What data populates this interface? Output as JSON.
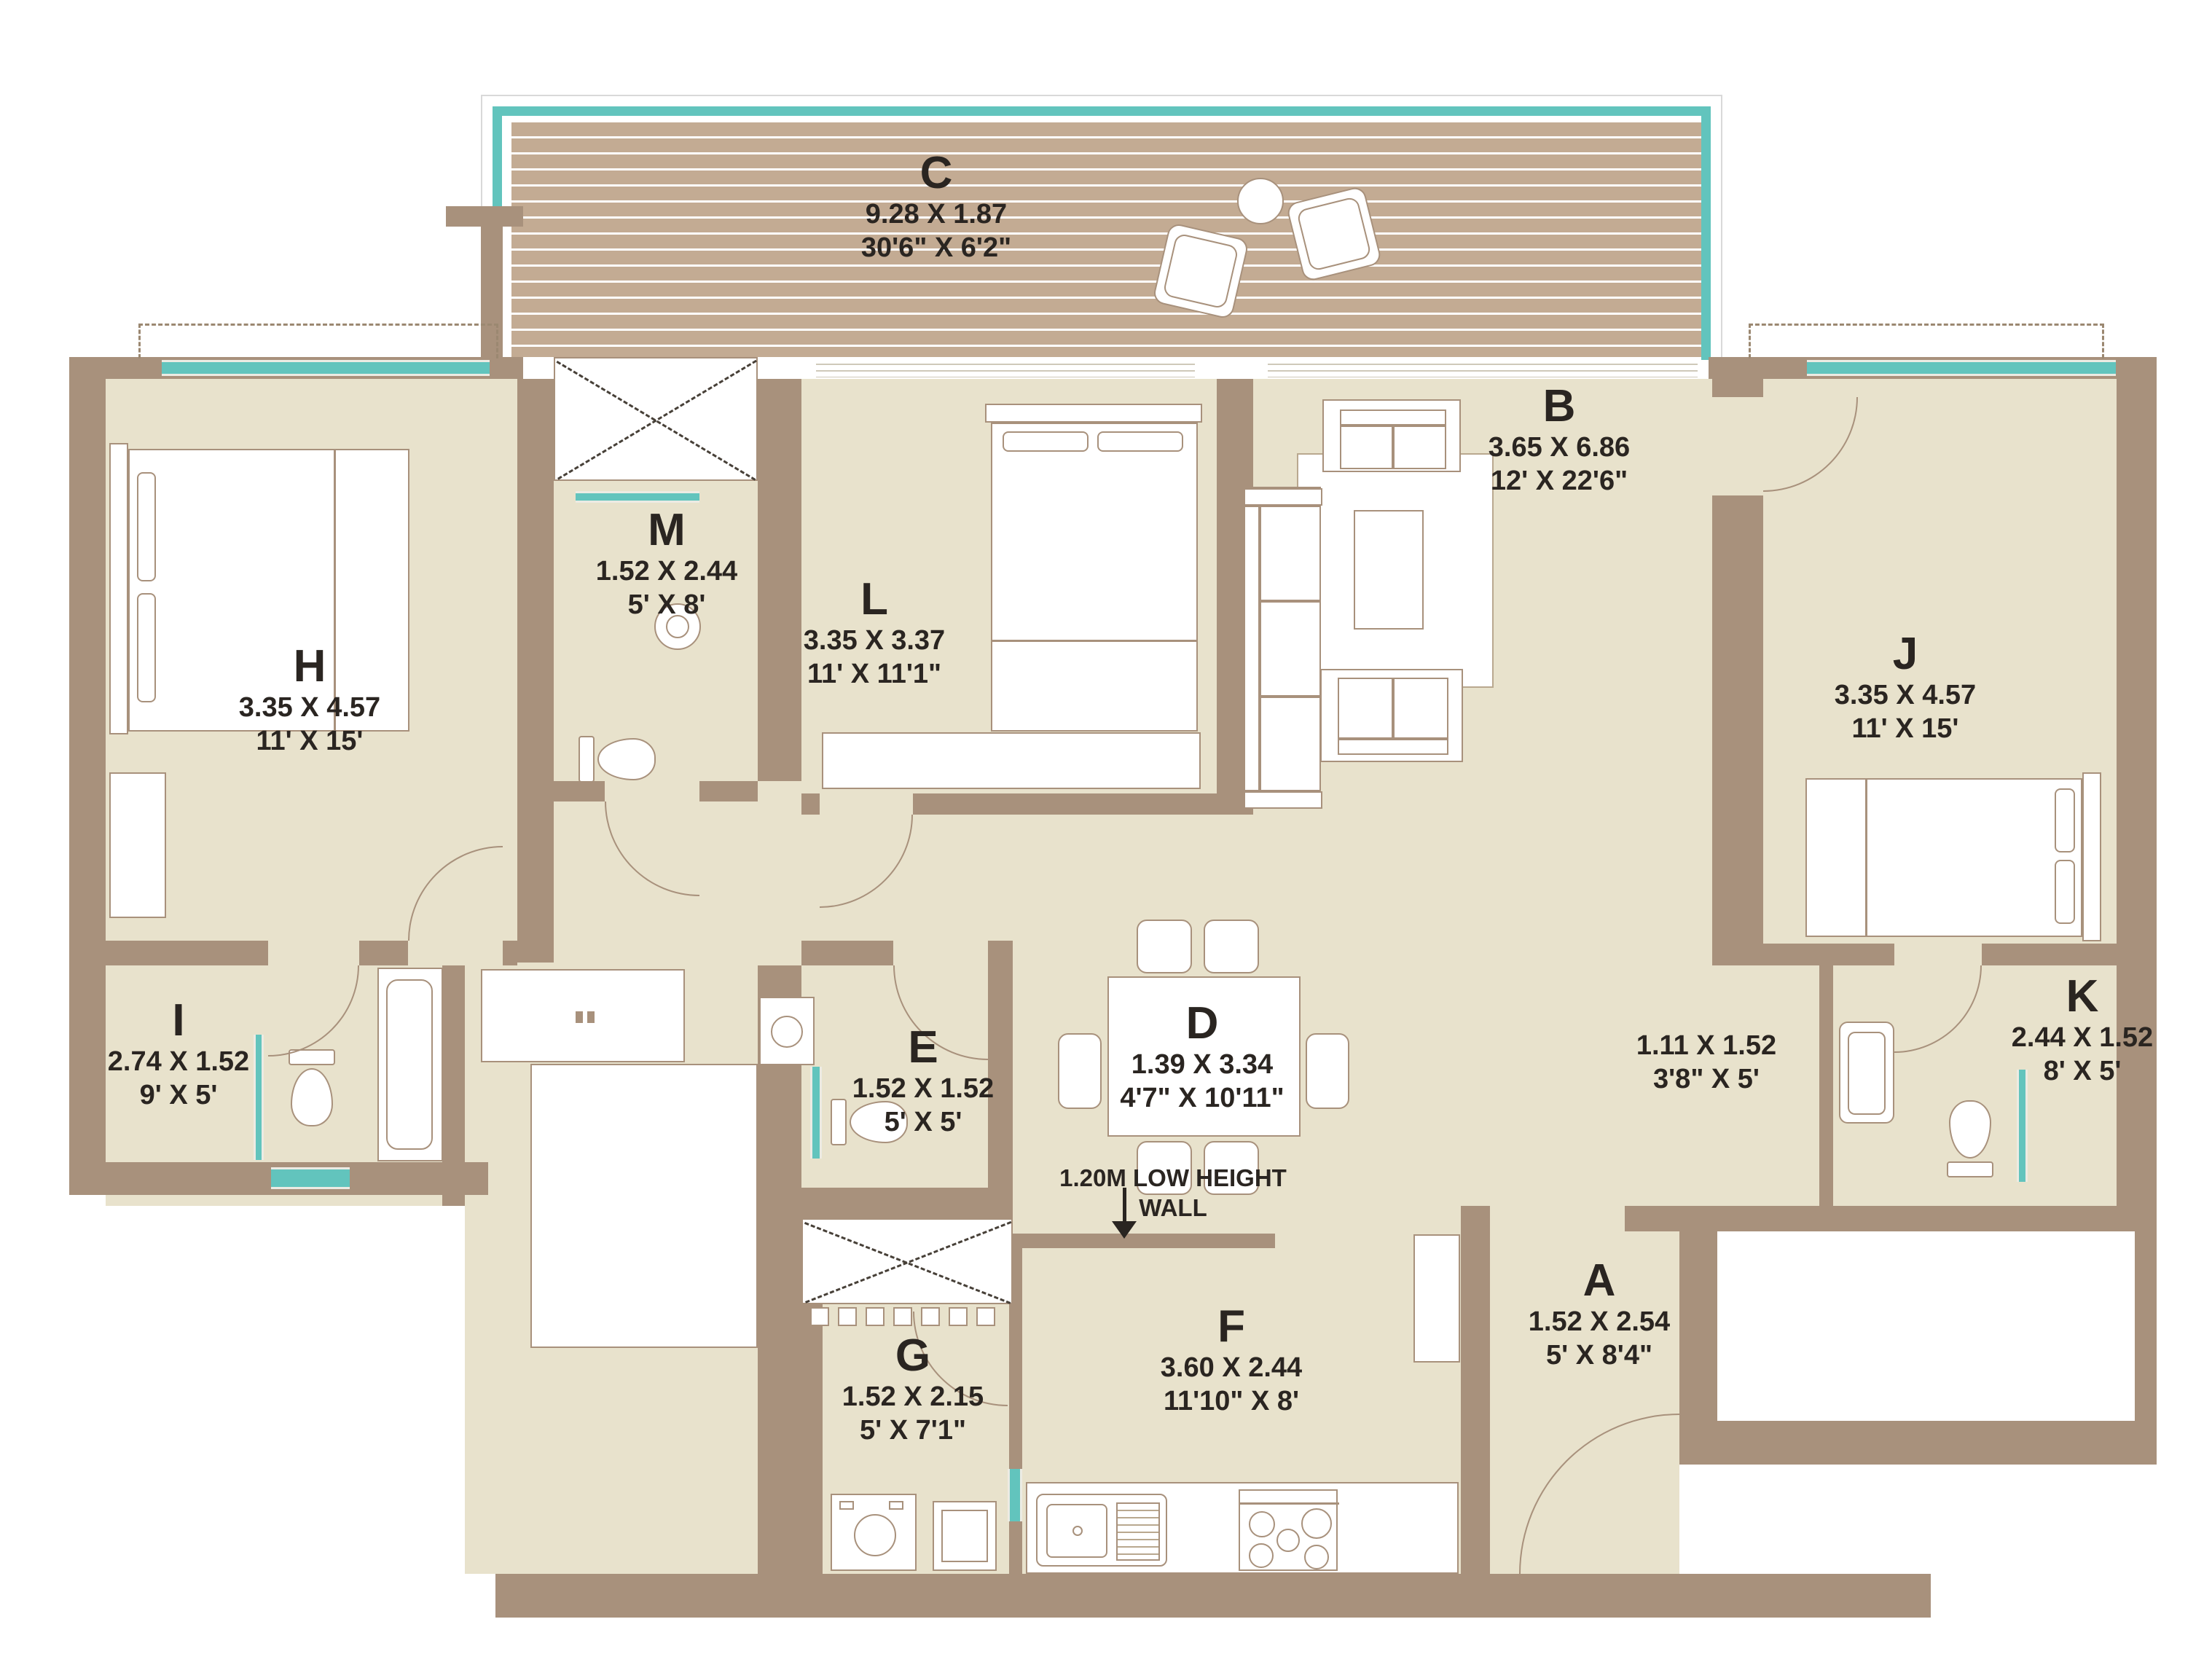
{
  "title": "3 BHK Apartment Floor Plan",
  "colors": {
    "wall": "#a8917c",
    "floor": "#e8e2cc",
    "deck": "#c3ab93",
    "window_accent": "#62c4bd",
    "text": "#2a2521",
    "background": "#ffffff"
  },
  "annotation": {
    "line1": "1.20M LOW HEIGHT",
    "line2": "WALL"
  },
  "rooms": [
    {
      "key": "C",
      "letter": "C",
      "metric": "9.28 X 1.87",
      "imperial": "30'6\" X 6'2\""
    },
    {
      "key": "H",
      "letter": "H",
      "metric": "3.35 X 4.57",
      "imperial": "11' X 15'"
    },
    {
      "key": "M",
      "letter": "M",
      "metric": "1.52 X 2.44",
      "imperial": "5' X 8'"
    },
    {
      "key": "L",
      "letter": "L",
      "metric": "3.35 X 3.37",
      "imperial": "11' X 11'1\""
    },
    {
      "key": "B",
      "letter": "B",
      "metric": "3.65 X 6.86",
      "imperial": "12' X 22'6\""
    },
    {
      "key": "J",
      "letter": "J",
      "metric": "3.35 X 4.57",
      "imperial": "11' X 15'"
    },
    {
      "key": "I",
      "letter": "I",
      "metric": "2.74 X 1.52",
      "imperial": "9' X 5'"
    },
    {
      "key": "E",
      "letter": "E",
      "metric": "1.52 X 1.52",
      "imperial": "5' X 5'"
    },
    {
      "key": "D",
      "letter": "D",
      "metric": "1.39 X 3.34",
      "imperial": "4'7\" X 10'11\""
    },
    {
      "key": "passage",
      "letter": "",
      "metric": "1.11 X 1.52",
      "imperial": "3'8\" X 5'"
    },
    {
      "key": "K",
      "letter": "K",
      "metric": "2.44 X 1.52",
      "imperial": "8' X 5'"
    },
    {
      "key": "G",
      "letter": "G",
      "metric": "1.52 X 2.15",
      "imperial": "5' X 7'1\""
    },
    {
      "key": "F",
      "letter": "F",
      "metric": "3.60 X 2.44",
      "imperial": "11'10\" X 8'"
    },
    {
      "key": "A",
      "letter": "A",
      "metric": "1.52 X 2.54",
      "imperial": "5' X 8'4\""
    }
  ]
}
